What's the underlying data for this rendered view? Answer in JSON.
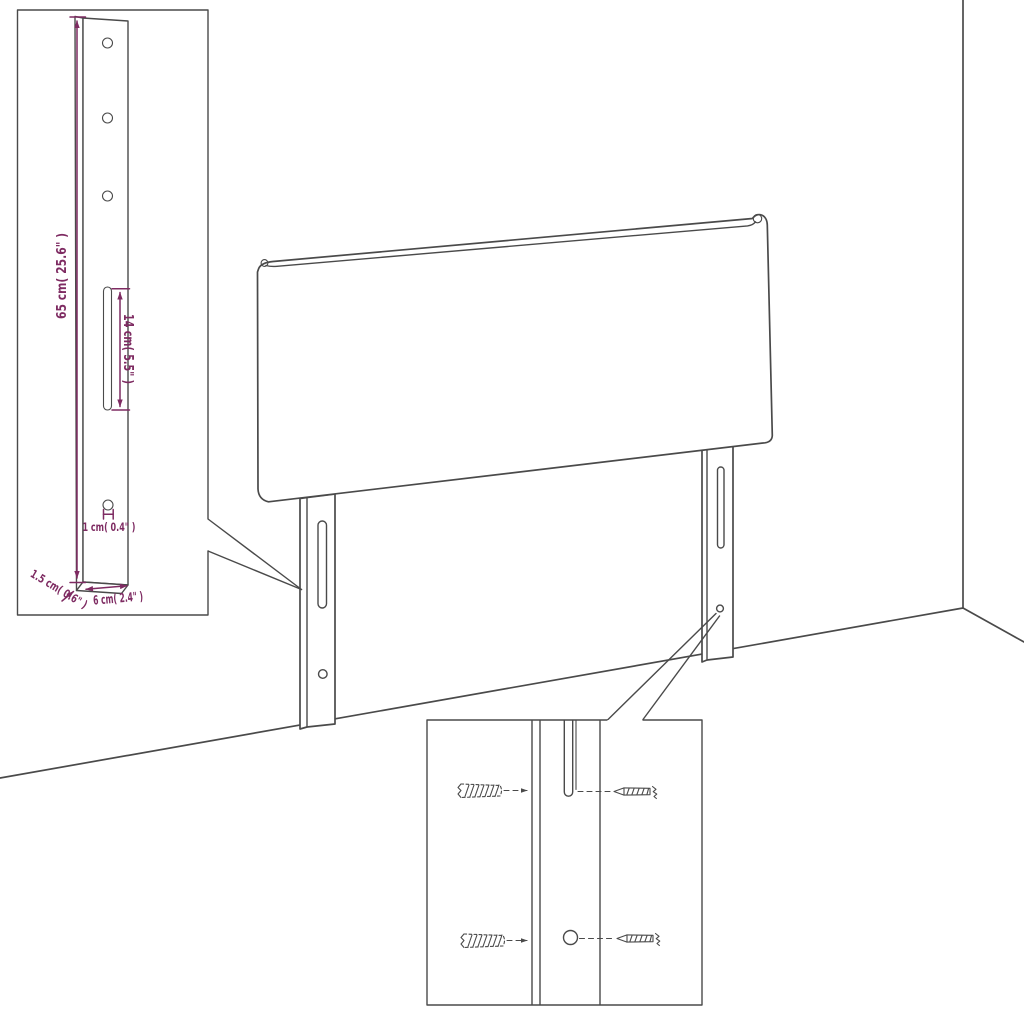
{
  "diagram": {
    "type": "headboard-assembly-instruction-illustration",
    "colors": {
      "outline": "#4a4a4a",
      "dimension": "#7e2b62",
      "background": "#ffffff"
    },
    "leg_detail_inset": {
      "labels": {
        "height": "65 cm( 25.6\" )",
        "slot_length": "14 cm( 5.5\" )",
        "hole_offset": "1 cm( 0.4\" )",
        "thickness": "1.5 cm( 0.6\" )",
        "width": "6 cm( 2.4\" )"
      }
    },
    "mounting_detail_inset": {
      "parts": [
        "wall-anchor",
        "screw"
      ]
    }
  }
}
